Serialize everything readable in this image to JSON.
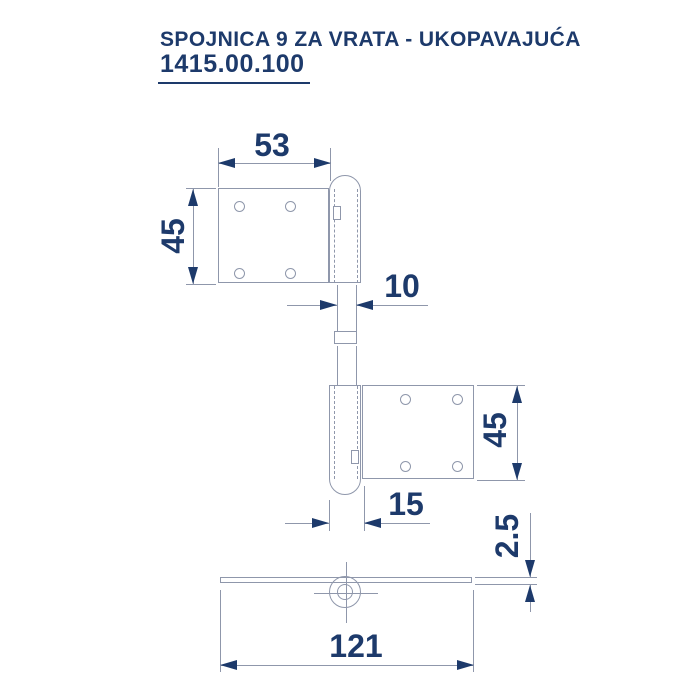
{
  "title": {
    "name": "SPOJNICA 9 ZA VRATA - UKOPAVAJUĆA",
    "part_number": "1415.00.100"
  },
  "colors": {
    "ink": "#1d3a6b",
    "line": "#8f97ab",
    "background": "#ffffff"
  },
  "dimensions": {
    "top_leaf_width": "53",
    "top_leaf_height": "45",
    "pin_width": "10",
    "bottom_leaf_height": "45",
    "knuckle_width": "15",
    "plate_thickness": "2.5",
    "total_length": "121"
  }
}
